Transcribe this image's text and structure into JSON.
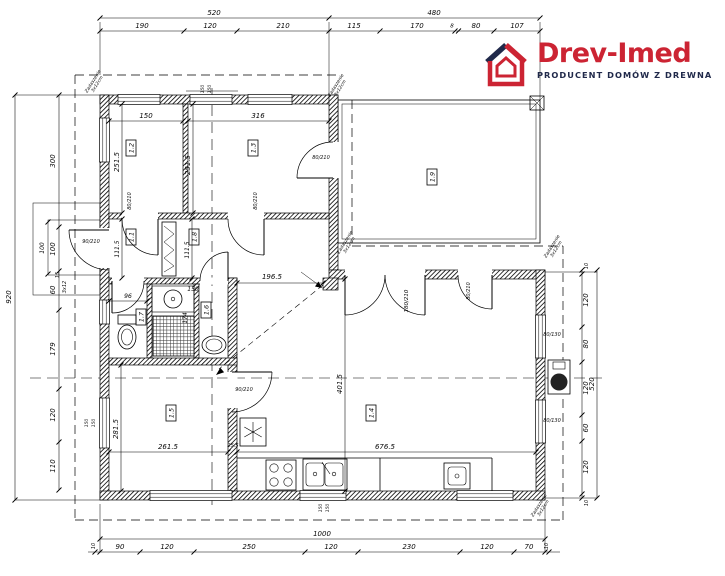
{
  "logo": {
    "name": "Drev-Imed",
    "tagline": "PRODUCENT DOMÓW Z DREWNA",
    "red": "#cc2433",
    "navy": "#20294a"
  },
  "dims": {
    "top": {
      "outer": [
        "520",
        "480"
      ],
      "inner": [
        "190",
        "120",
        "210",
        "115",
        "170",
        "8",
        "80",
        "107"
      ]
    },
    "bottom": {
      "outer": "1000",
      "inner": [
        "10",
        "90",
        "120",
        "250",
        "120",
        "230",
        "120",
        "70",
        "10"
      ]
    },
    "left": {
      "outer": "920",
      "inner": [
        "300",
        "100",
        "60",
        "179",
        "120",
        "110"
      ]
    },
    "right": {
      "outer": "520",
      "inner": [
        "10",
        "120",
        "80",
        "120",
        "60",
        "120",
        "10"
      ]
    }
  },
  "rooms": [
    "1.1",
    "1.2",
    "1.3",
    "1.4",
    "1.5",
    "1.6",
    "1.7",
    "1.8",
    "1.9"
  ],
  "interior": {
    "w12": "150",
    "w13": "316",
    "h12": "251.5",
    "h13": "251.5",
    "h11": "111.5",
    "h18": "111.5",
    "w17": "96",
    "basin": "150",
    "h16": "174",
    "pass": "196.5",
    "w15": "261.5",
    "wall": "25.5",
    "h15": "281.5",
    "w14": "676.5",
    "h14": "401.5",
    "porch": "100",
    "step": "15",
    "steps": "3x12"
  },
  "openings": {
    "entry": "90/210",
    "interior_80": "80/210",
    "kitchen": "90/210",
    "double": "180/210",
    "window_small": "80/130",
    "window_mark": "150"
  },
  "annotations": {
    "canopy1": "Zadaszenie",
    "canopy2": "3x12cm"
  }
}
